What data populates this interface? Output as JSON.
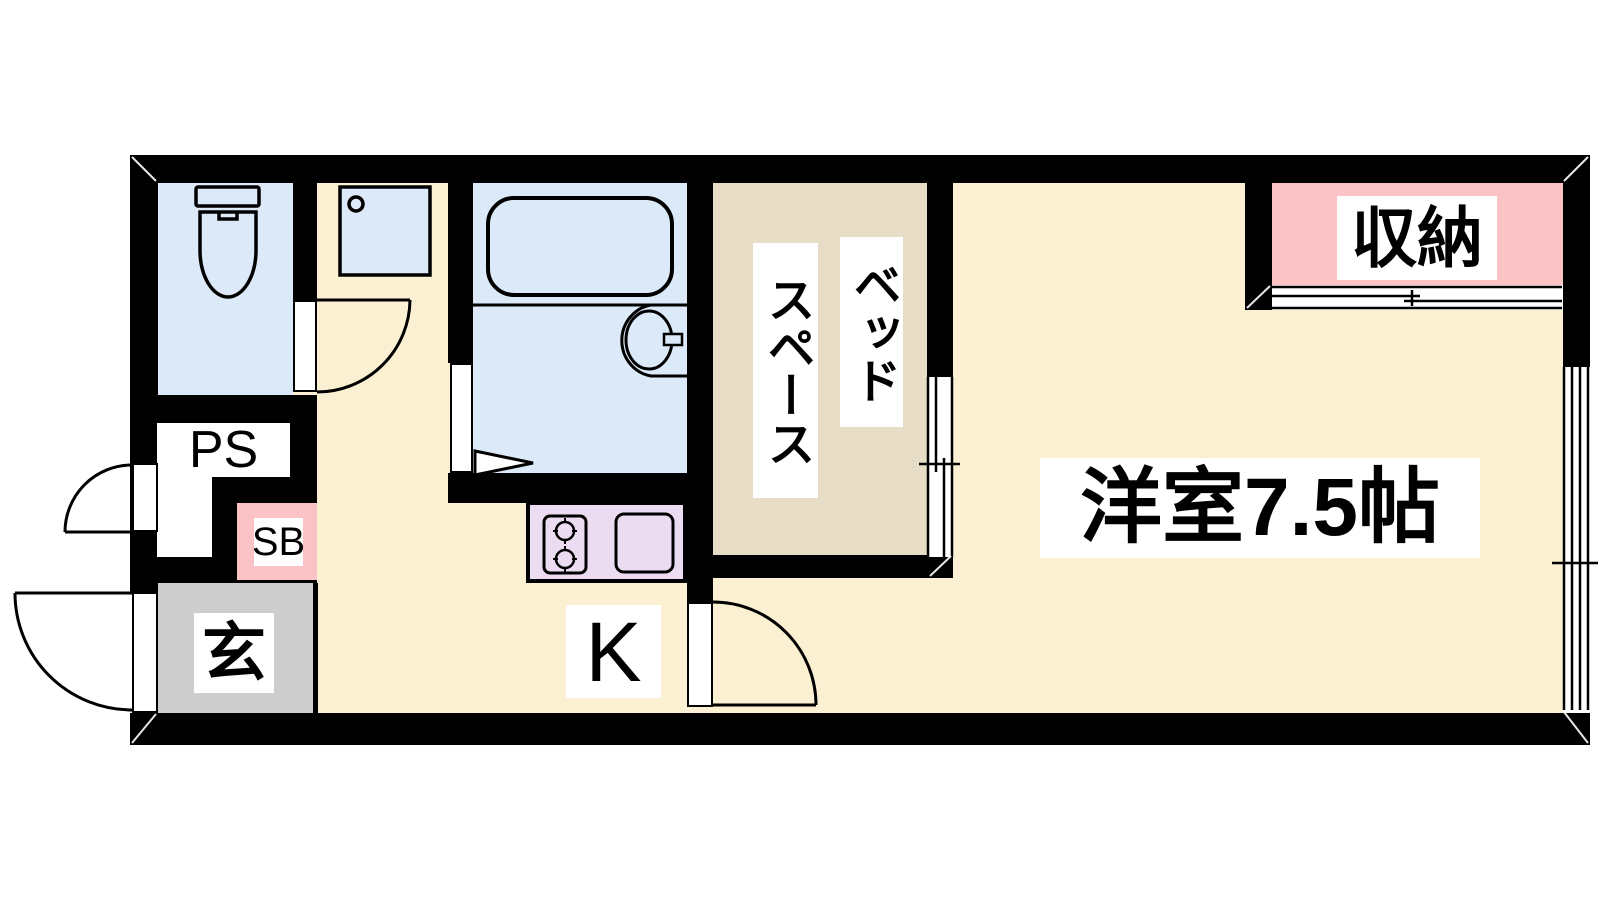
{
  "floorplan": {
    "title_hint": "1K apartment floor plan",
    "labels": {
      "pipe_space": "PS",
      "shoe_box": "SB",
      "entrance": "玄",
      "kitchen": "K",
      "bed_space_col_right": "ベッド",
      "bed_space_col_left": "スペース",
      "main_room": "洋室7.5帖",
      "storage": "収納"
    },
    "colors": {
      "wall": "#000000",
      "floor_cream": "#FCF0D2",
      "wet_area_blue": "#DCE9F8",
      "bed_space_tan": "#E7DCC6",
      "storage_pink": "#FBC3C6",
      "kitchen_counter_purple": "#EBDCF2",
      "entrance_gray": "#CDCDCD"
    }
  }
}
